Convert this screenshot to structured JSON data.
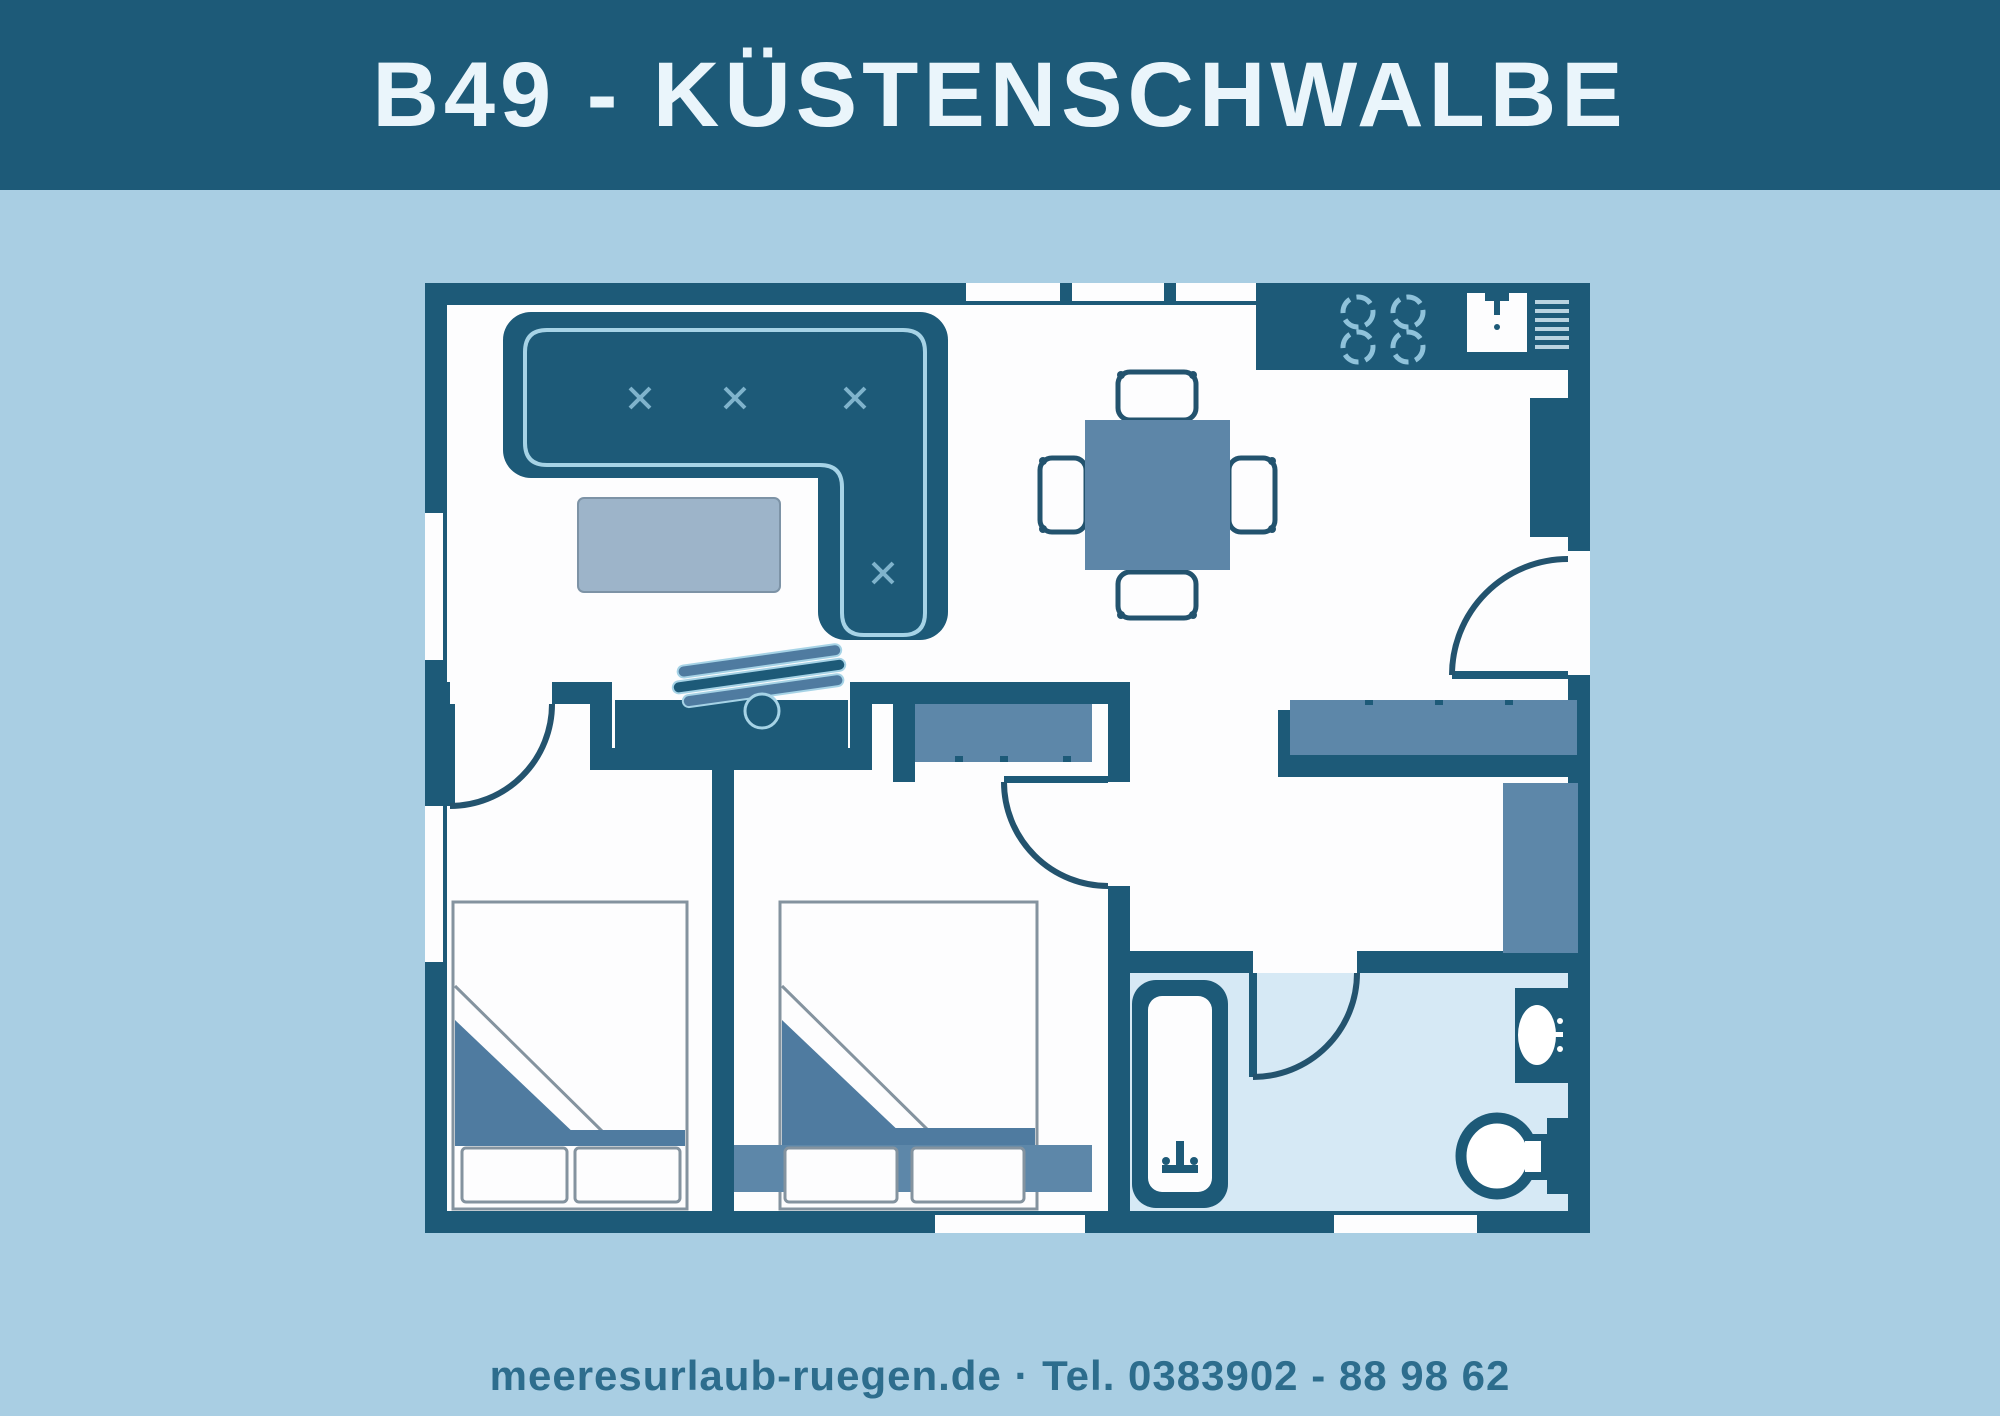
{
  "header": {
    "title": "B49 - KÜSTENSCHWALBE"
  },
  "footer": {
    "contact": "meeresurlaub-ruegen.de · Tel. 0383902 - 88 98 62"
  },
  "palette": {
    "dark": "#1d5a78",
    "page_bg": "#a9cee3",
    "room": "#fdfdfe",
    "bath_floor": "#d6e9f5",
    "medium": "#5d87a9",
    "blanket": "#4f7ba0",
    "coffee_table": "#9db4c9",
    "accent_light": "#a6d3e6",
    "outline_gray": "#84939f",
    "header_text": "#eaf5fb",
    "footer_text": "#2d6d8d",
    "door_stroke": "#23536e"
  },
  "floorplan": {
    "icons": [
      "corner-sofa-icon",
      "coffee-table-icon",
      "dining-table-icon",
      "chair-icon",
      "stove-burners-icon",
      "kitchen-sink-icon",
      "dish-rack-icon",
      "tall-cabinet-icon",
      "sideboard-icon",
      "hall-cabinet-icon",
      "wardrobe-icon",
      "clothes-hanger-icon",
      "dresser-icon",
      "double-bed-icon",
      "pillow-icon",
      "bathtub-icon",
      "washbasin-icon",
      "toilet-icon",
      "door-swing-icon",
      "window-icon"
    ]
  }
}
